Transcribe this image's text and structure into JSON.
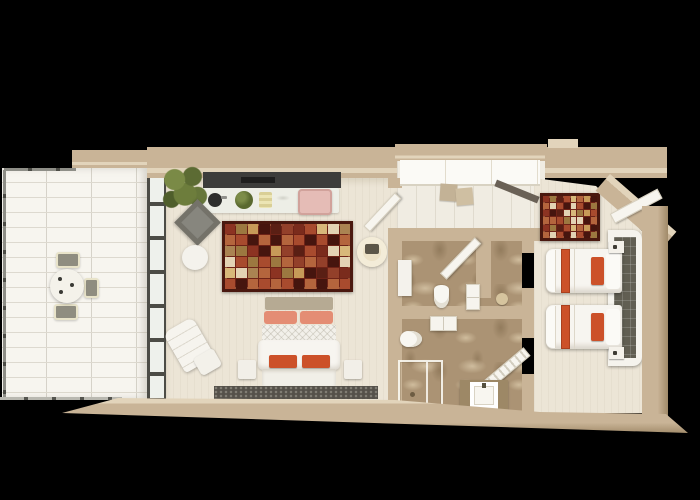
{
  "scene": {
    "type": "3d-rendered-floor-plan",
    "description": "Top-down 3D floor plan of a hotel suite on a black background",
    "background": "#000000"
  },
  "palette": {
    "bg": "#000000",
    "wall": "#c9b497",
    "wall_light": "#e2d4bb",
    "wall_shadow": "#a08a69",
    "floor_cream": "#ece5d6",
    "floor_tile": "#f7f5ef",
    "tile_grout": "#ddd9cf",
    "marble_base": "#ab9374",
    "glass_frame": "#4c4c46",
    "dark_panel": "#3d3d3b",
    "runner_dark": "#55514a",
    "headboard_tile": "#615e52",
    "accent_orange": "#cc5129",
    "accent_salmon": "#e48d74",
    "accent_pink": "#e5bcb6",
    "plant_green": "#69793a",
    "stool_gray": "#8f8d80",
    "white_furniture": "#f6f4ef"
  },
  "rugs": {
    "main": {
      "cols": 11,
      "rows": 6,
      "palette": [
        "#8c3322",
        "#a84b2e",
        "#c79a58",
        "#e3d3b4",
        "#5a1f14",
        "#b4653d",
        "#7a2b1c",
        "#9c7840",
        "#d8b87a",
        "#46150e",
        "#aa8352",
        "#93402a"
      ]
    },
    "twin": {
      "cols": 8,
      "rows": 6,
      "palette": [
        "#8c3322",
        "#a84b2e",
        "#c79a58",
        "#e3d3b4",
        "#5a1f14",
        "#b4653d",
        "#7a2b1c",
        "#9c7840",
        "#d8b87a",
        "#46150e"
      ]
    }
  },
  "rooms": {
    "terrace": {
      "label": "terrace",
      "items": [
        "glass-railing",
        "round-dining-table",
        "three-chairs",
        "white-tile-floor"
      ]
    },
    "main_bedroom": {
      "label": "main-bedroom",
      "items": [
        "kitchenette-counter",
        "sink",
        "plants",
        "pink-ottoman",
        "patchwork-rug",
        "double-bed",
        "two-nightstands",
        "lounge-chair-with-ottoman",
        "round-ottoman",
        "gray-accent-chair",
        "round-cream-chair",
        "dark-floor-runner",
        "sliding-glass-door"
      ]
    },
    "dressing_area": {
      "label": "dressing-area",
      "items": [
        "wardrobe-with-sliding-doors",
        "folded-items",
        "luggage-rail"
      ]
    },
    "bathroom_1": {
      "label": "bathroom-1",
      "items": [
        "toilet",
        "wall-vanity",
        "washstand",
        "round-stool",
        "open-door",
        "marble-floor"
      ]
    },
    "bathroom_2": {
      "label": "bathroom-2",
      "items": [
        "toilet",
        "double-vanity",
        "glass-shower",
        "sink-on-marble-base",
        "slatted-door",
        "marble-floor"
      ]
    },
    "twin_bedroom": {
      "label": "twin-bedroom",
      "items": [
        "twin-bed-1",
        "twin-bed-2",
        "tiled-headboard-panel",
        "small-patchwork-rug",
        "two-cube-nightstands",
        "entry-door",
        "angled-corner-wall"
      ]
    }
  }
}
